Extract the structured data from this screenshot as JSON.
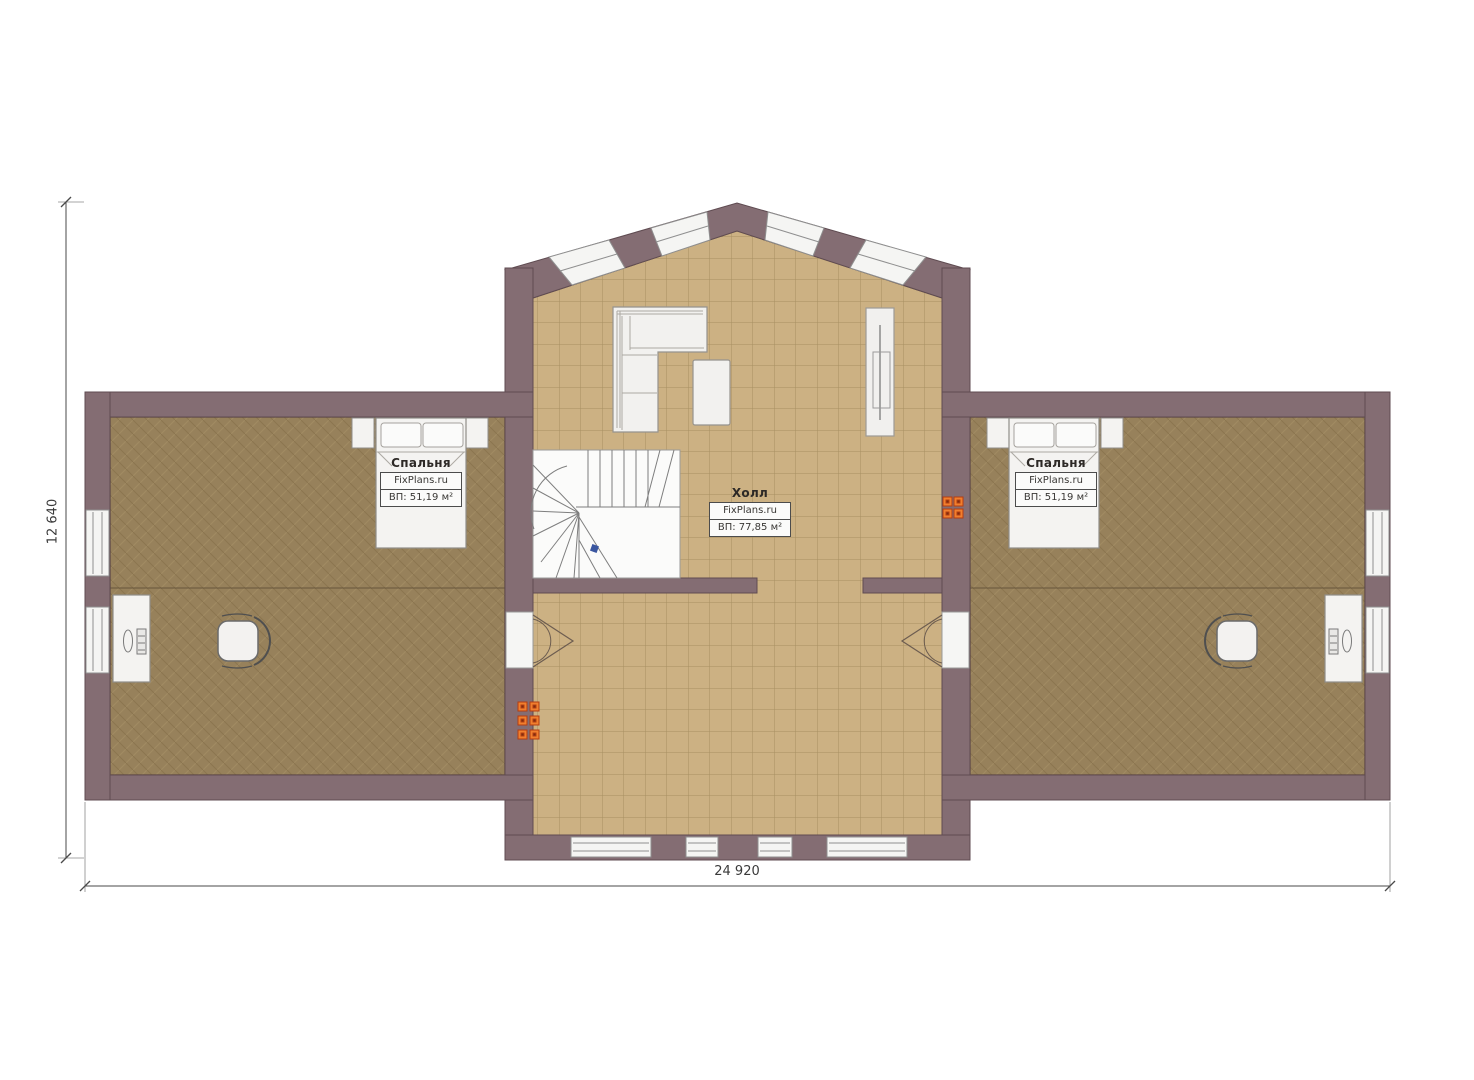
{
  "plan": {
    "rooms": [
      {
        "id": "bedroom-left",
        "name": "Спальня",
        "brand": "FixPlans.ru",
        "area": "ВП: 51,19 м²"
      },
      {
        "id": "hall",
        "name": "Холл",
        "brand": "FixPlans.ru",
        "area": "ВП: 77,85 м²"
      },
      {
        "id": "bedroom-right",
        "name": "Спальня",
        "brand": "FixPlans.ru",
        "area": "ВП: 51,19 м²"
      }
    ],
    "dimensions": {
      "height": "12 640",
      "width": "24 920"
    },
    "colors": {
      "wall": "#846d73",
      "wall_outline": "#5f4b51",
      "hall_floor": "#ccb183",
      "hall_grid": "#a18a5d",
      "bedroom_floor": "#97815b",
      "window": "#f5f5f3",
      "furniture": "#f2f1ef",
      "vent_marker_orange": "#f07f2e",
      "stair_marker_blue": "#3a56a0"
    }
  }
}
